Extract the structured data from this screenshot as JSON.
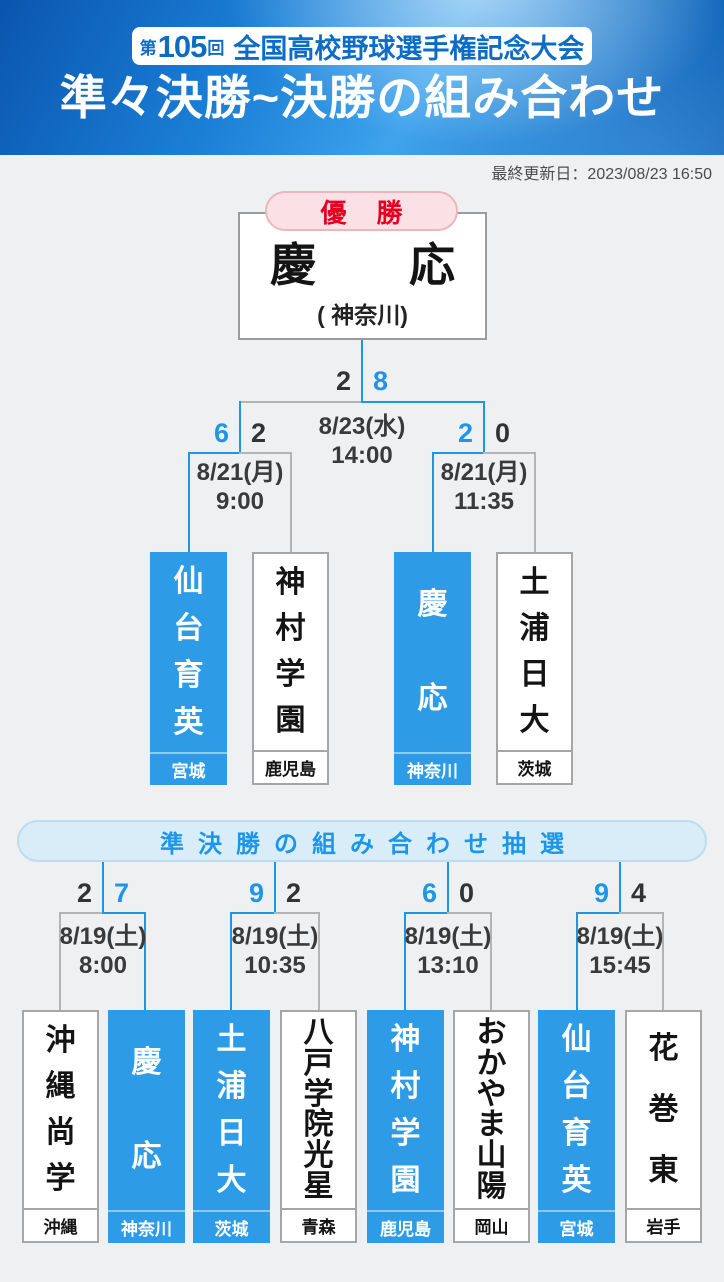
{
  "header": {
    "badge": {
      "prefix": "第",
      "number": "105",
      "suffix": "回",
      "title": "全国高校野球選手権記念大会"
    },
    "title": "準々決勝~決勝の組み合わせ",
    "updated": "最終更新日：2023/08/23 16:50"
  },
  "colors": {
    "accent_blue": "#1e96e8",
    "box_blue": "#2d9be5",
    "line_gray": "#b4b4b4",
    "pill_pink": "#fbe1e5",
    "pill_red_text": "#e50021",
    "header_blue": "#1b7fd6"
  },
  "champion": {
    "label": "優勝",
    "name": "慶応",
    "prefecture": "( 神奈川)"
  },
  "final": {
    "date": "8/23(水)",
    "time": "14:00",
    "score_left": "2",
    "score_right": "8",
    "winner_side": "right"
  },
  "semifinals": [
    {
      "date": "8/21(月)",
      "time": "9:00",
      "score_left": "6",
      "score_right": "2",
      "winner_side": "left",
      "teams": [
        {
          "name": "仙台育英",
          "prefecture": "宮城",
          "winner": true
        },
        {
          "name": "神村学園",
          "prefecture": "鹿児島",
          "winner": false
        }
      ]
    },
    {
      "date": "8/21(月)",
      "time": "11:35",
      "score_left": "2",
      "score_right": "0",
      "winner_side": "left",
      "teams": [
        {
          "name": "慶応",
          "prefecture": "神奈川",
          "winner": true
        },
        {
          "name": "土浦日大",
          "prefecture": "茨城",
          "winner": false
        }
      ]
    }
  ],
  "draw_banner": "準決勝の組み合わせ抽選",
  "quarterfinals": [
    {
      "date": "8/19(土)",
      "time": "8:00",
      "score_left": "2",
      "score_right": "7",
      "winner_side": "right",
      "teams": [
        {
          "name": "沖縄尚学",
          "prefecture": "沖縄",
          "winner": false
        },
        {
          "name": "慶応",
          "prefecture": "神奈川",
          "winner": true
        }
      ]
    },
    {
      "date": "8/19(土)",
      "time": "10:35",
      "score_left": "9",
      "score_right": "2",
      "winner_side": "left",
      "teams": [
        {
          "name": "土浦日大",
          "prefecture": "茨城",
          "winner": true
        },
        {
          "name": "八戸学院光星",
          "prefecture": "青森",
          "winner": false
        }
      ]
    },
    {
      "date": "8/19(土)",
      "time": "13:10",
      "score_left": "6",
      "score_right": "0",
      "winner_side": "left",
      "teams": [
        {
          "name": "神村学園",
          "prefecture": "鹿児島",
          "winner": true
        },
        {
          "name": "おかやま山陽",
          "prefecture": "岡山",
          "winner": false
        }
      ]
    },
    {
      "date": "8/19(土)",
      "time": "15:45",
      "score_left": "9",
      "score_right": "4",
      "winner_side": "left",
      "teams": [
        {
          "name": "仙台育英",
          "prefecture": "宮城",
          "winner": true
        },
        {
          "name": "花巻東",
          "prefecture": "岩手",
          "winner": false
        }
      ]
    }
  ]
}
